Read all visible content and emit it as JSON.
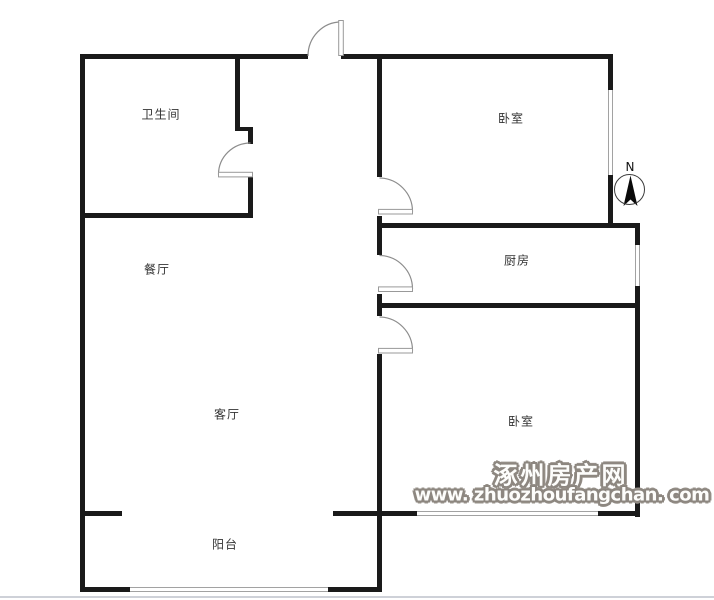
{
  "plan": {
    "rooms": {
      "bathroom": {
        "label": "卫生间"
      },
      "bedroom_top": {
        "label": "卧室"
      },
      "dining": {
        "label": "餐厅"
      },
      "kitchen": {
        "label": "厨房"
      },
      "living": {
        "label": "客厅"
      },
      "bedroom_bottom": {
        "label": "卧室"
      },
      "balcony": {
        "label": "阳台"
      }
    },
    "compass": {
      "label": "N"
    },
    "watermark": {
      "site_name": "涿州房产网",
      "site_url": "www. zhuozhoufangchan. com"
    },
    "colors": {
      "wall": "#1a1a1a",
      "door_arc": "#8c8c8c",
      "door_leaf_edge": "#999999",
      "window_edge": "#a2a2a2",
      "watermark": "#8d8780",
      "room_label": "#333333"
    }
  }
}
